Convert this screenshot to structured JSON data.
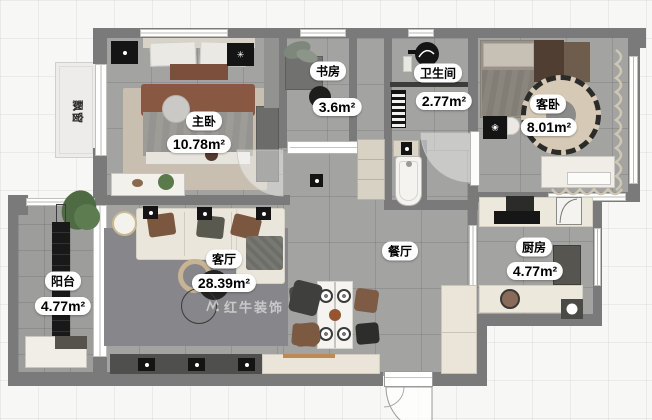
{
  "meta": {
    "type": "apartment-floor-plan"
  },
  "watermark": {
    "text": "红牛装饰"
  },
  "rooms": {
    "master_bedroom": {
      "name": "主卧",
      "area": "10.78m²"
    },
    "study": {
      "name": "书房",
      "area": "3.6m²"
    },
    "bathroom": {
      "name": "卫生间",
      "area": "2.77m²"
    },
    "guest_bedroom": {
      "name": "客卧",
      "area": "8.01m²"
    },
    "living_room": {
      "name": "客厅",
      "area": "28.39m²"
    },
    "dining_room": {
      "name": "餐厅",
      "area": ""
    },
    "kitchen": {
      "name": "厨房",
      "area": "4.77m²"
    },
    "balcony": {
      "name": "阳台",
      "area": "4.77m²"
    },
    "bay_window": {
      "name": "飘窗",
      "area": ""
    }
  },
  "colors": {
    "outside": "#f7f7f5",
    "wall": "#7a7a7a",
    "floor_tile": "#a3a3a1",
    "rug_living": "#87878b",
    "rug_beige": "#c8bfb0",
    "counter": "#ece8db",
    "accent_wood": "#bf8a52",
    "label_bg": "#ffffff",
    "label_text": "#000000"
  }
}
